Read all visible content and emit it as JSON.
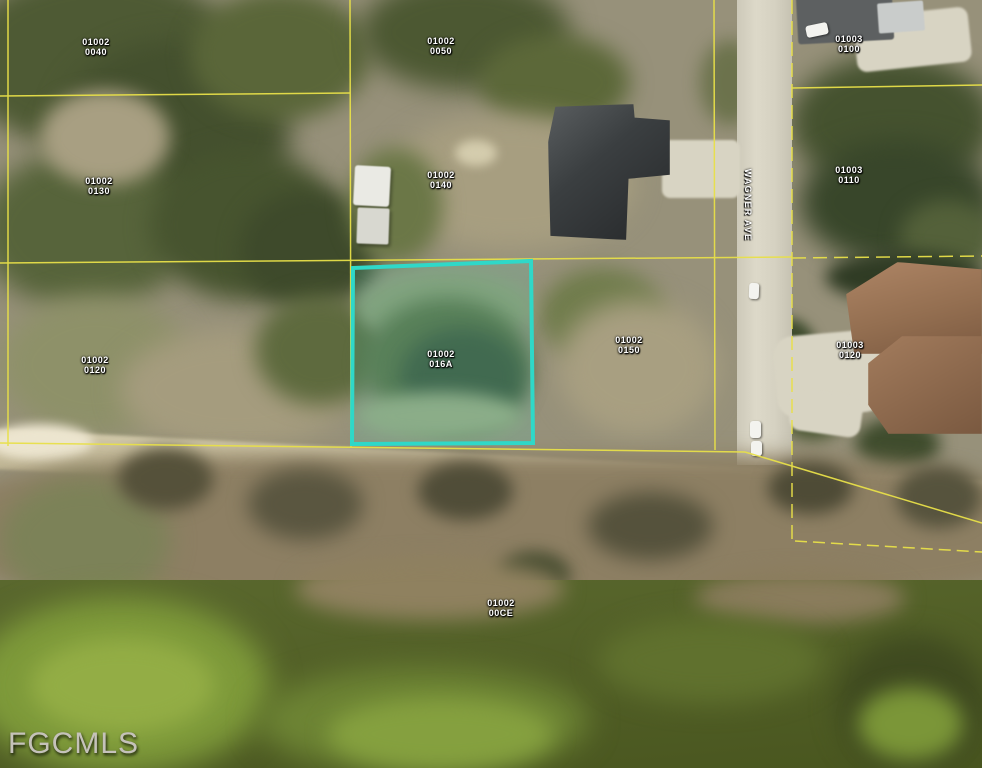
{
  "watermark": {
    "text": "FGCMLS"
  },
  "street": {
    "name": "WAGNER AVE"
  },
  "subject_parcel": {
    "book": "01002",
    "lot": "016A",
    "highlight_color": "#2fd8c8"
  },
  "parcels": [
    {
      "book": "01002",
      "lot": "0040"
    },
    {
      "book": "01002",
      "lot": "0050"
    },
    {
      "book": "01003",
      "lot": "0100"
    },
    {
      "book": "01002",
      "lot": "0130"
    },
    {
      "book": "01002",
      "lot": "0140"
    },
    {
      "book": "01003",
      "lot": "0110"
    },
    {
      "book": "01002",
      "lot": "016A"
    },
    {
      "book": "01002",
      "lot": "0150"
    },
    {
      "book": "01002",
      "lot": "0120"
    },
    {
      "book": "01003",
      "lot": "0120"
    },
    {
      "book": "01002",
      "lot": "00CE"
    }
  ],
  "overlay_colors": {
    "parcel_line": "#e8e049",
    "label_text": "#ffffff"
  }
}
